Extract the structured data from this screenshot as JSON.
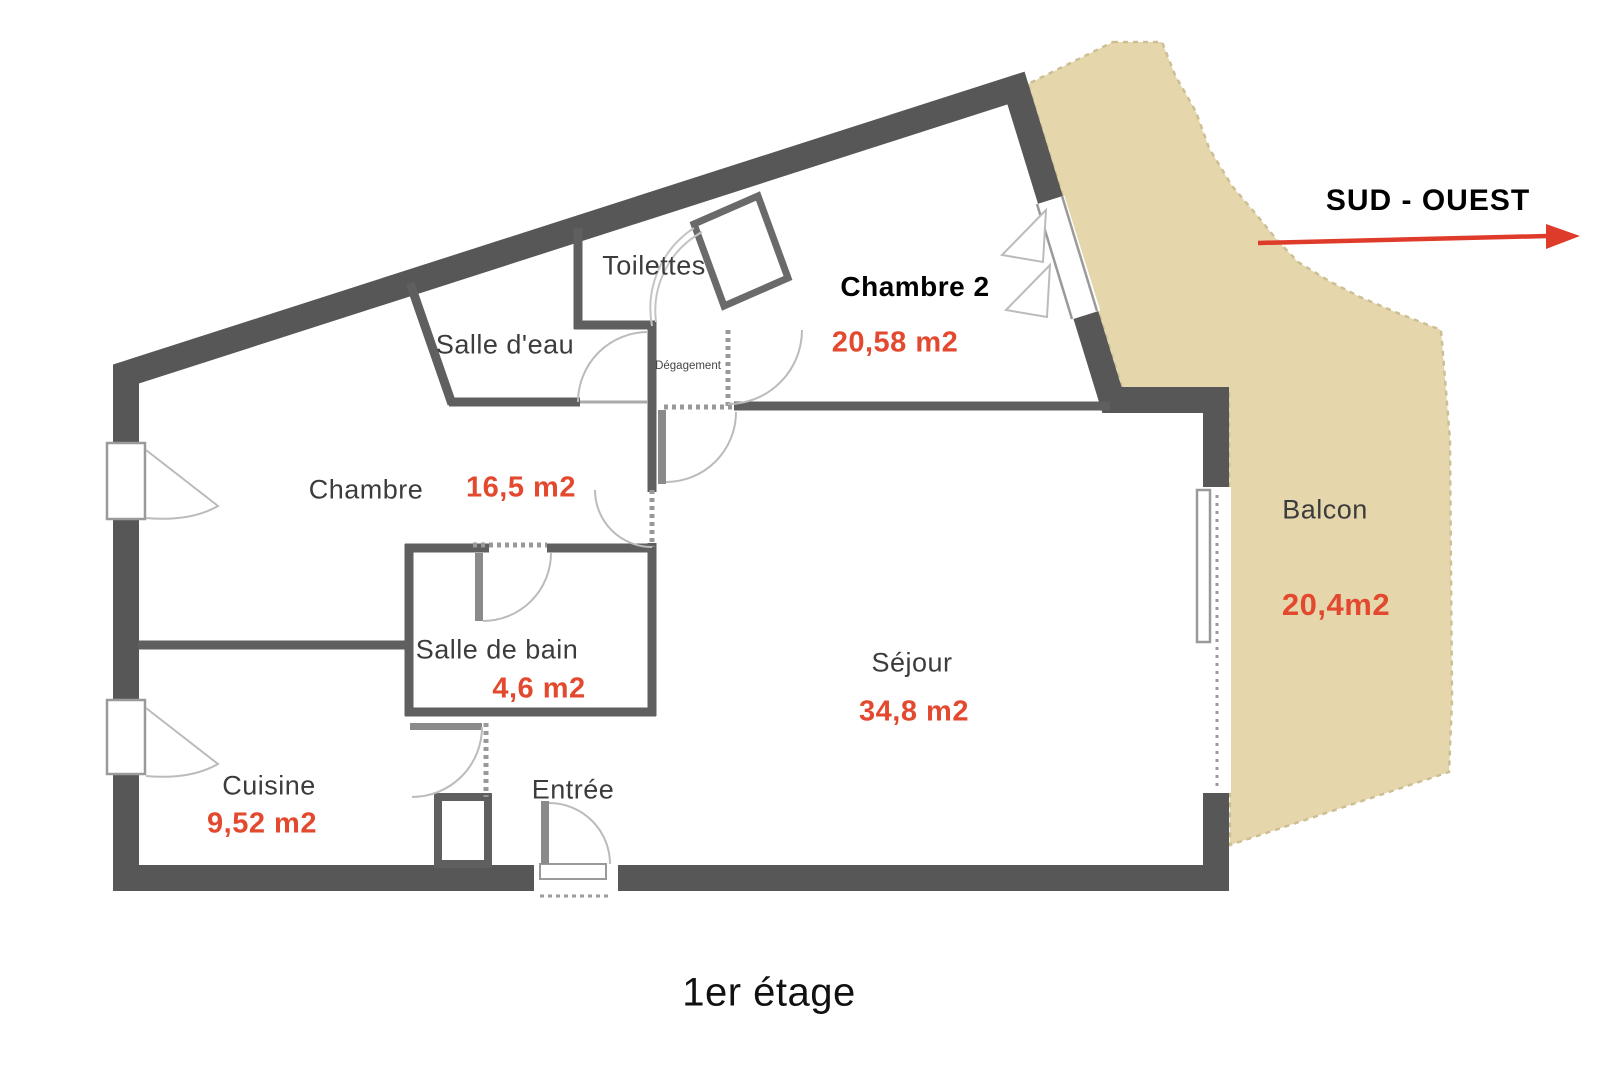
{
  "floor_plan": {
    "caption": "1er étage",
    "compass": {
      "label": "SUD - OUEST",
      "direction": "arrow-right"
    },
    "rooms": {
      "toilettes": {
        "name": "Toilettes"
      },
      "salle_deau": {
        "name": "Salle d'eau"
      },
      "chambre2": {
        "name": "Chambre 2",
        "area": "20,58 m2"
      },
      "degagement": {
        "name": "Dégagement"
      },
      "chambre": {
        "name": "Chambre",
        "area": "16,5 m2"
      },
      "salle_de_bain": {
        "name": "Salle de bain",
        "area": "4,6 m2"
      },
      "sejour": {
        "name": "Séjour",
        "area": "34,8 m2"
      },
      "cuisine": {
        "name": "Cuisine",
        "area": "9,52 m2"
      },
      "entree": {
        "name": "Entrée"
      },
      "balcon": {
        "name": "Balcon",
        "area": "20,4m2"
      }
    },
    "colors": {
      "wall": "#575757",
      "balcony_fill": "#e5d6ac",
      "balcony_edge": "#cdbf94",
      "area_text": "#e2492e",
      "arrow": "#df3b2a",
      "room_label_text": "#3c3c3c",
      "door_arc": "#bbbbbb"
    }
  }
}
